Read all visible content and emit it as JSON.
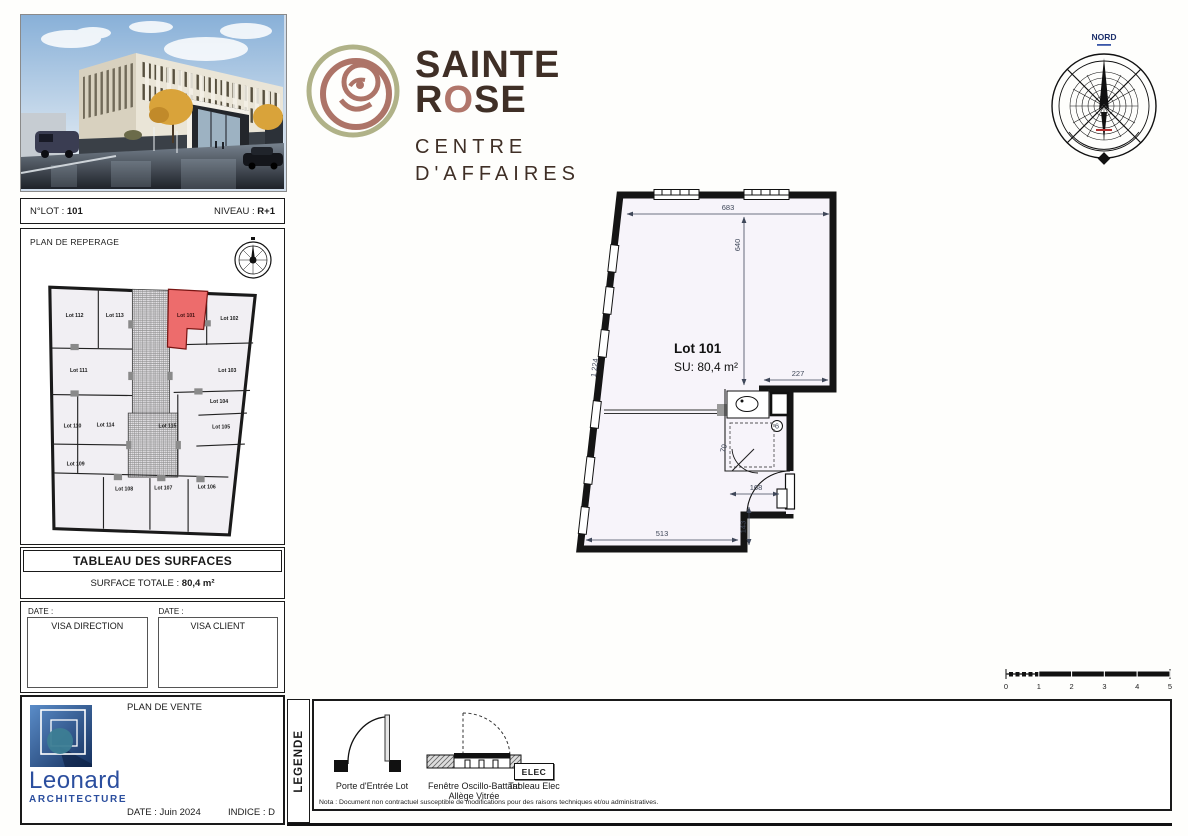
{
  "lot_bar": {
    "lot_label": "N°LOT :",
    "lot_value": "101",
    "level_label": "NIVEAU :",
    "level_value": "R+1"
  },
  "reperage": {
    "title": "PLAN DE REPERAGE",
    "lots": [
      {
        "label": "Lot 112",
        "x": 32,
        "y": 35
      },
      {
        "label": "Lot 113",
        "x": 71,
        "y": 35
      },
      {
        "label": "Lot 101",
        "x": 140,
        "y": 35,
        "hl": true
      },
      {
        "label": "Lot 102",
        "x": 182,
        "y": 38
      },
      {
        "label": "Lot 111",
        "x": 36,
        "y": 88
      },
      {
        "label": "Lot 103",
        "x": 180,
        "y": 88
      },
      {
        "label": "Lot 110",
        "x": 30,
        "y": 142
      },
      {
        "label": "Lot 114",
        "x": 62,
        "y": 141
      },
      {
        "label": "Lot 115",
        "x": 122,
        "y": 142
      },
      {
        "label": "Lot 104",
        "x": 172,
        "y": 118
      },
      {
        "label": "Lot 105",
        "x": 174,
        "y": 143
      },
      {
        "label": "Lot 109",
        "x": 33,
        "y": 179
      },
      {
        "label": "Lot 108",
        "x": 80,
        "y": 203
      },
      {
        "label": "Lot 107",
        "x": 118,
        "y": 202
      },
      {
        "label": "Lot 106",
        "x": 160,
        "y": 201
      }
    ]
  },
  "surfaces": {
    "title": "TABLEAU DES SURFACES",
    "total_label": "SURFACE TOTALE :",
    "total_value": "80,4 m²"
  },
  "visa": {
    "date_label": "DATE :",
    "left_box": "VISA DIRECTION",
    "right_box": "VISA CLIENT"
  },
  "titleblock": {
    "doc_title": "PLAN DE VENTE",
    "date": "DATE : Juin 2024",
    "indice": "INDICE : D",
    "firm_name": "Leonard",
    "firm_sub": "ARCHITECTURE"
  },
  "brand": {
    "line1": "SAINTE",
    "line2_parts": [
      "R",
      "O",
      "SE"
    ],
    "sub1": "CENTRE",
    "sub2": "D'AFFAIRES",
    "brown": "#3f2f26",
    "rose": "#b1766b",
    "olive": "#b0b288"
  },
  "compass": {
    "label": "NORD"
  },
  "plan": {
    "lot_title": "Lot 101",
    "surface": "SU: 80,4 m²",
    "dims": {
      "top": "683",
      "height": "640",
      "slant": "1 224",
      "step": "227",
      "door": "168",
      "notch": "143",
      "bottom": "513",
      "wc": "70",
      "note": "6"
    }
  },
  "scalebar": {
    "ticks": [
      "0",
      "1",
      "2",
      "3",
      "4",
      "5"
    ]
  },
  "legend": {
    "tab": "LEGENDE",
    "door_label": "Porte d'Entrée Lot",
    "window_label1": "Fenêtre Oscillo-Battant",
    "window_label2": "Allège Vitrée",
    "elec_symbol": "ELEC",
    "elec_label": "Tableau Elec",
    "nota": "Nota : Document non contractuel susceptible de modifications pour des raisons techniques et/ou administratives."
  },
  "colors": {
    "highlight_red": "#ed6c6c",
    "dim_text": "#3f4759",
    "leonard_blue": "#2b4e9e",
    "room_fill": "#f7f4fa"
  }
}
